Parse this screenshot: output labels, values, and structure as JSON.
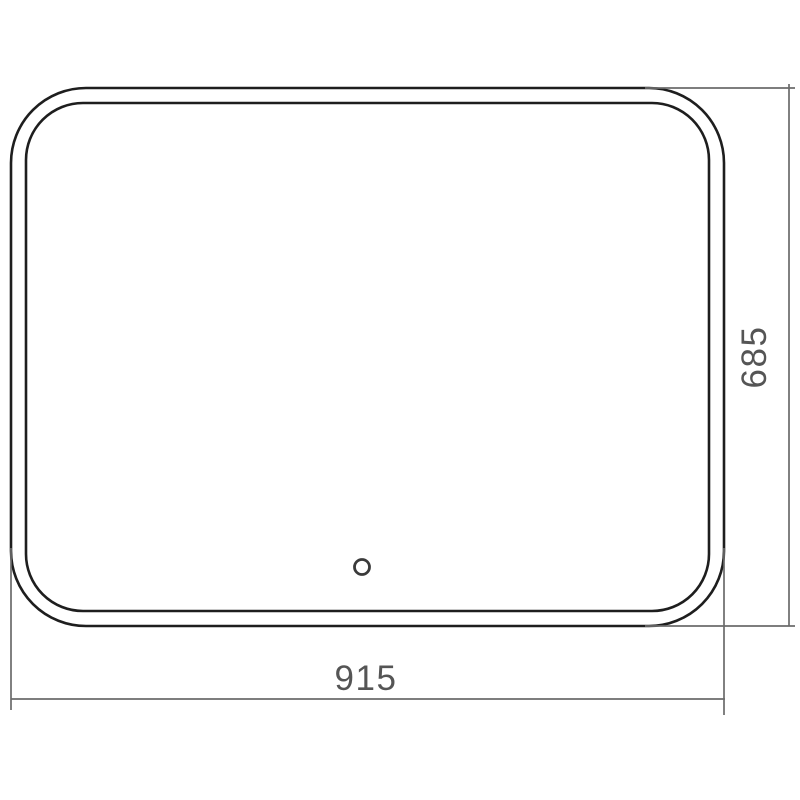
{
  "drawing": {
    "type": "mirror-dimension-diagram",
    "dimensions": {
      "width_label": "915",
      "height_label": "685"
    },
    "colors": {
      "background": "#ffffff",
      "outline": "#1e1e1e",
      "dimension_line": "#6b6b6b",
      "label_text": "#555555"
    }
  }
}
